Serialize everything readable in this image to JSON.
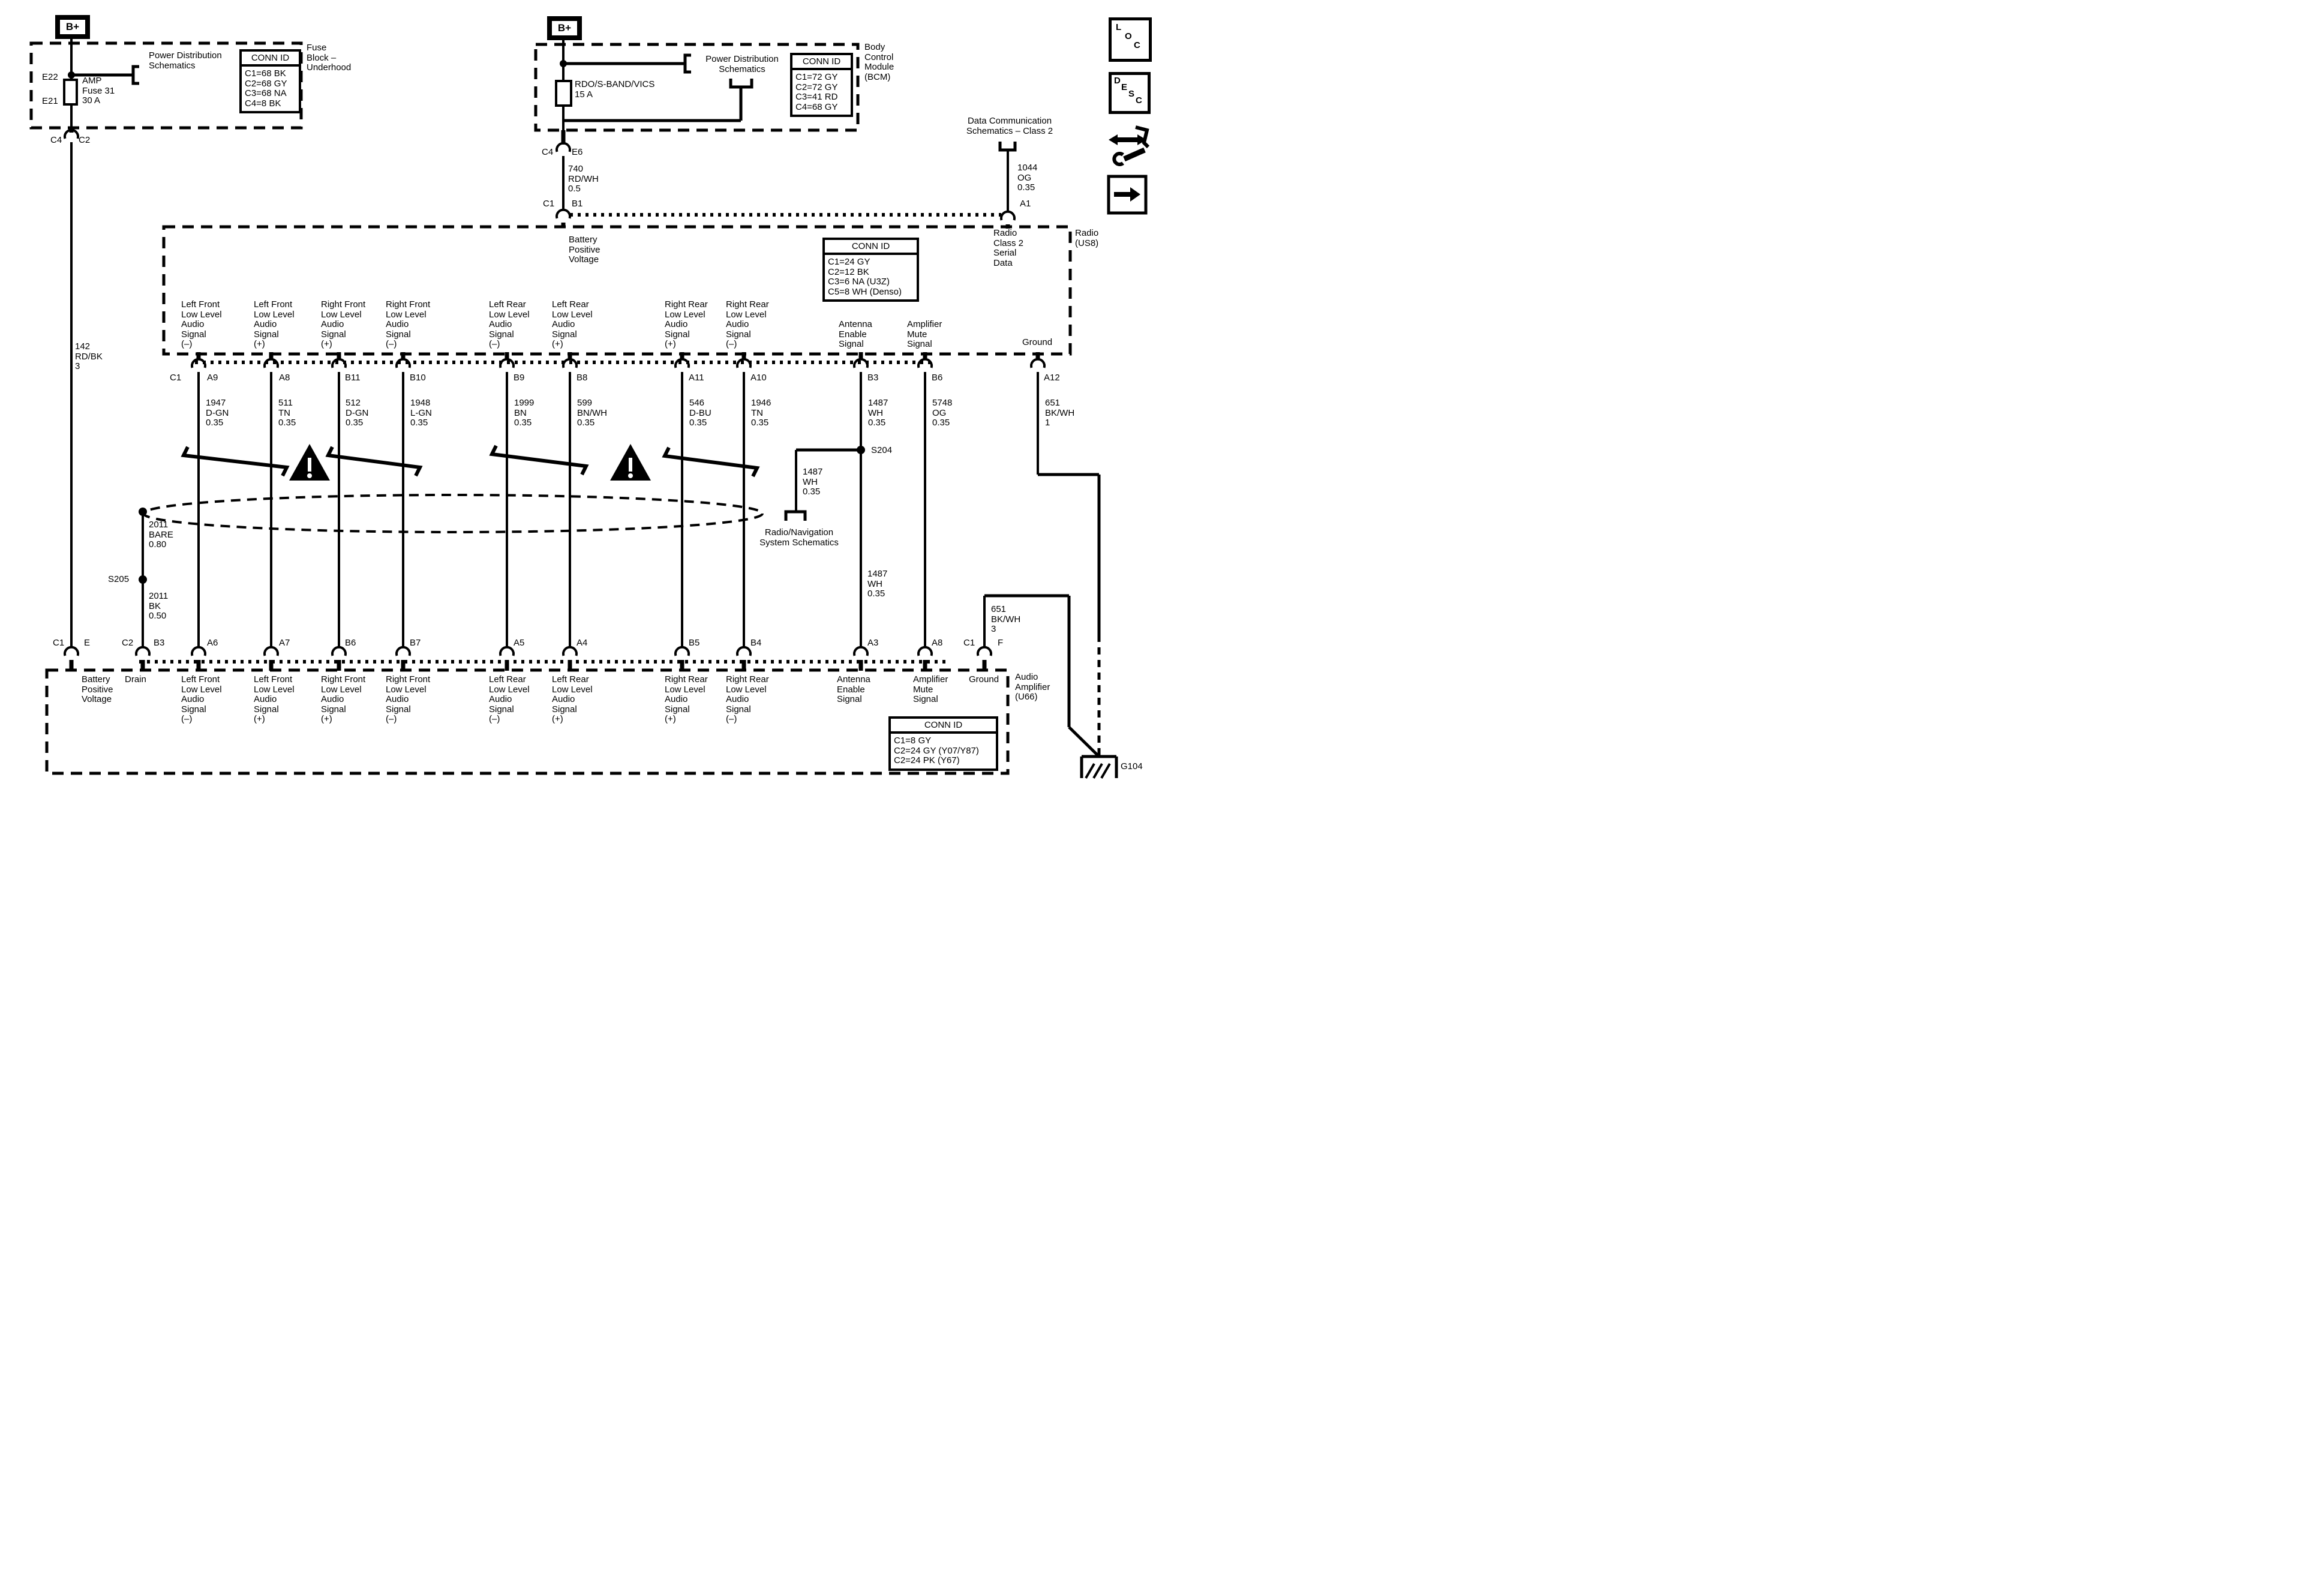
{
  "colors": {
    "ink": "#000000",
    "paper": "#ffffff"
  },
  "refs": {
    "power_distribution": "Power Distribution\nSchematics",
    "data_comm": "Data Communication\nSchematics – Class 2",
    "radio_nav": "Radio/Navigation\nSystem Schematics"
  },
  "fuse_block": {
    "bplus": "B+",
    "name": "Fuse\nBlock –\nUnderhood",
    "fuse_top": "E22",
    "fuse_bottom": "E21",
    "fuse_label": "AMP\nFuse 31\n30 A",
    "conn_id": {
      "header": "CONN ID",
      "rows": "C1=68 BK\nC2=68 GY\nC3=68 NA\nC4=8 BK"
    },
    "conn_left": "C4",
    "conn_right": "C2"
  },
  "bcm": {
    "bplus": "B+",
    "name": "Body\nControl\nModule\n(BCM)",
    "fuse_label": "RDO/S-BAND/VICS\n15 A",
    "conn_id": {
      "header": "CONN ID",
      "rows": "C1=72 GY\nC2=72 GY\nC3=41 RD\nC4=68 GY"
    },
    "conn1_left": "C4",
    "conn1_right": "E6",
    "conn2_left": "C1",
    "conn2_right": "B1"
  },
  "radio": {
    "name": "Radio\n(US8)",
    "serial": "Radio\nClass 2\nSerial\nData",
    "ground": "Ground",
    "battery": "Battery\nPositive\nVoltage",
    "a1": "A1",
    "conn_id": {
      "header": "CONN ID",
      "rows": "C1=24 GY\nC2=12 BK\nC3=6 NA (U3Z)\nC5=8 WH (Denso)"
    },
    "pins": [
      "C1",
      "A9",
      "A8",
      "B11",
      "B10",
      "B9",
      "B8",
      "A11",
      "A10",
      "B3",
      "B6",
      "A12"
    ]
  },
  "amplifier": {
    "name": "Audio\nAmplifier\n(U66)",
    "battery": "Battery\nPositive\nVoltage",
    "drain": "Drain",
    "ground": "Ground",
    "conn_id": {
      "header": "CONN ID",
      "rows": "C1=8 GY\nC2=24 GY (Y07/Y87)\nC2=24 PK (Y67)"
    },
    "pins": [
      "C1",
      "E",
      "C2",
      "B3",
      "A6",
      "A7",
      "B6",
      "B7",
      "A5",
      "A4",
      "B5",
      "B4",
      "A3",
      "A8",
      "C1",
      "F"
    ]
  },
  "signals": [
    "Left Front\nLow Level\nAudio\nSignal\n(–)",
    "Left Front\nLow Level\nAudio\nSignal\n(+)",
    "Right Front\nLow Level\nAudio\nSignal\n(+)",
    "Right Front\nLow Level\nAudio\nSignal\n(–)",
    "Left Rear\nLow Level\nAudio\nSignal\n(–)",
    "Left Rear\nLow Level\nAudio\nSignal\n(+)",
    "Right Rear\nLow Level\nAudio\nSignal\n(+)",
    "Right Rear\nLow Level\nAudio\nSignal\n(–)",
    "Antenna\nEnable\nSignal",
    "Amplifier\nMute\nSignal"
  ],
  "wire_labels": [
    "1947\nD-GN\n0.35",
    "511\nTN\n0.35",
    "512\nD-GN\n0.35",
    "1948\nL-GN\n0.35",
    "1999\nBN\n0.35",
    "599\nBN/WH\n0.35",
    "546\nD-BU\n0.35",
    "1946\nTN\n0.35",
    "1487\nWH\n0.35",
    "5748\nOG\n0.35",
    "651\nBK/WH\n1"
  ],
  "wires": {
    "batt_left": "142\nRD/BK\n3",
    "batt_mid": "740\nRD/WH\n0.5",
    "data_comm": "1044\nOG\n0.35",
    "drain_upper": "2011\nBARE\n0.80",
    "drain_lower": "2011\nBK\n0.50",
    "s205": "S205",
    "s204": "S204",
    "antenna_branch": "1487\nWH\n0.35",
    "antenna_lower": "1487\nWH\n0.35",
    "amp_ground": "651\nBK/WH\n3",
    "g104": "G104"
  },
  "conn_labels": {
    "fuse_c4": "C4",
    "fuse_c2": "C2",
    "bcm_c4": "C4",
    "bcm_e6": "E6",
    "bcm_c1": "C1",
    "bcm_b1": "B1"
  },
  "icons": {
    "loc": [
      "L",
      "O",
      "C"
    ],
    "desc": [
      "D",
      "E",
      "S",
      "C"
    ]
  }
}
